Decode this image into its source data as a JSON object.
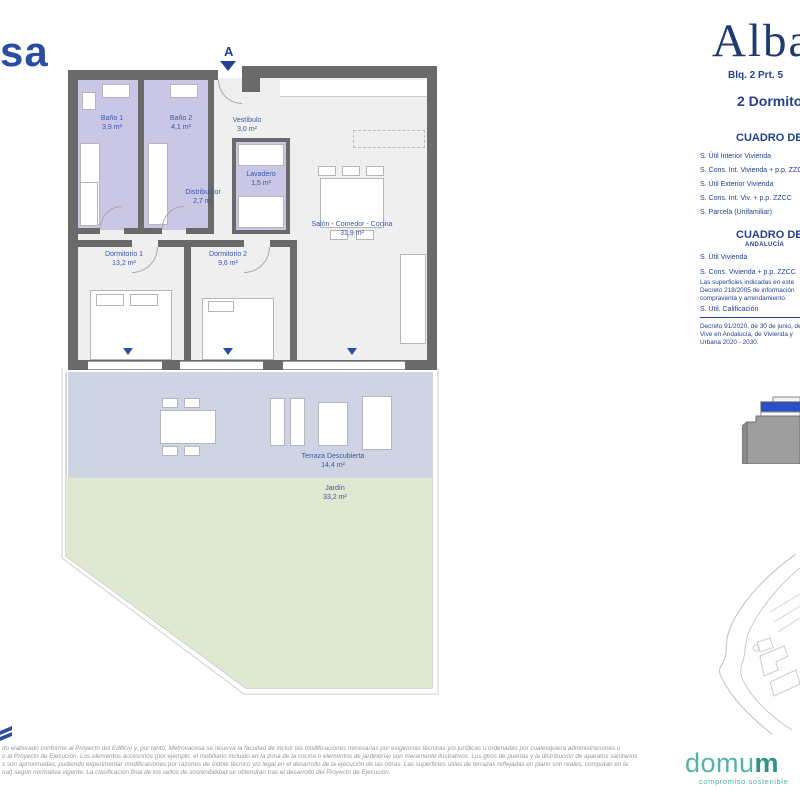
{
  "branding": {
    "metrovacesa_partial": "sa",
    "project_logo": "Alba",
    "domum_logo": "domu",
    "domum_logo_bold": "m",
    "domum_tagline": "compromiso sostenible"
  },
  "header": {
    "unit_ref": "Blq. 2 Prt. 5",
    "unit_type": "2 Dormitorios",
    "orientation_marker": "A"
  },
  "surface_tables": {
    "table1": {
      "title": "CUADRO DE SUPERFICIES",
      "rows": [
        "S. Útil Interior Vivienda",
        "S. Cons. Int. Vivienda + p.p. ZZCC",
        "S. Útil Exterior Vivienda",
        "S. Cons. Int. Viv. + p.p. ZZCC",
        "S. Parcela (Unifamiliar)"
      ]
    },
    "table2": {
      "title": "CUADRO DE SUPERFICIES",
      "subtitle": "ANDALUCÍA",
      "rows": [
        "S. Útil Vivienda",
        "S. Cons. Vivienda + p.p. ZZCC"
      ],
      "note1_lines": [
        "Las superficies indicadas en este",
        "Decreto 218/2005 de información",
        "compraventa y arrendamiento."
      ],
      "calificacion_label": "S. Útil. Calificación",
      "note2_lines": [
        "Decreto 91/2020, de 30 de junio, del",
        "Vive en Andalucía, de Vivienda y",
        "Urbana 2020 - 2030."
      ]
    }
  },
  "floor_plan": {
    "rooms": [
      {
        "name": "Baño 1",
        "area": "3,9 m²"
      },
      {
        "name": "Baño 2",
        "area": "4,1 m²"
      },
      {
        "name": "Vestíbulo",
        "area": "3,0 m²"
      },
      {
        "name": "Lavadero",
        "area": "1,5 m²"
      },
      {
        "name": "Distribuidor",
        "area": "2,7 m²"
      },
      {
        "name": "Dormitorio 1",
        "area": "13,2 m²"
      },
      {
        "name": "Dormitorio 2",
        "area": "9,6 m²"
      },
      {
        "name": "Salón - Comedor - Cocina",
        "area": "31,9 m²"
      },
      {
        "name": "Terraza Descubierta",
        "area": "14,4 m²"
      },
      {
        "name": "Jardín",
        "area": "33,2 m²"
      }
    ]
  },
  "disclaimer": {
    "lines": [
      "do elaborado conforme al Proyecto del Edificio y, por tanto, Metrovacesa se reserva la facultad de incluir las modificaciones necesarias por exigencias técnicas y/o jurídicas u ordenadas por cualesquiera administraciones u",
      "o al Proyecto de Ejecución. Los elementos accesorios (por ejemplo, el mobiliario incluido en la zona de la cocina o elementos de jardinería) son meramente ilustrativos. Los giros de puertas y la distribución de aparatos sanitarios",
      "s son aproximadas, pudiendo experimentar modificaciones por razones de índole técnico y/o legal en el desarrollo de la ejecución de las obras. Las superficies útiles de terrazas reflejadas en plano son reales, computan en la",
      "nal) según normativa vigente. La clasificación final de los sellos de sostenibilidad se obtendrán tras el desarrollo del Proyecto de Ejecución."
    ]
  },
  "colors": {
    "navy_text": "#24418e",
    "logo_blue": "#2a4fa2",
    "wall_gray": "#6a6a6a",
    "floor_gray": "#efeff0",
    "bath_lavender": "#c9c6e6",
    "terrace_blue": "#ced4e4",
    "garden_green": "#dfe9d2",
    "domum_teal": "#53b3a6",
    "marker_blue": "#2b4ea2"
  }
}
